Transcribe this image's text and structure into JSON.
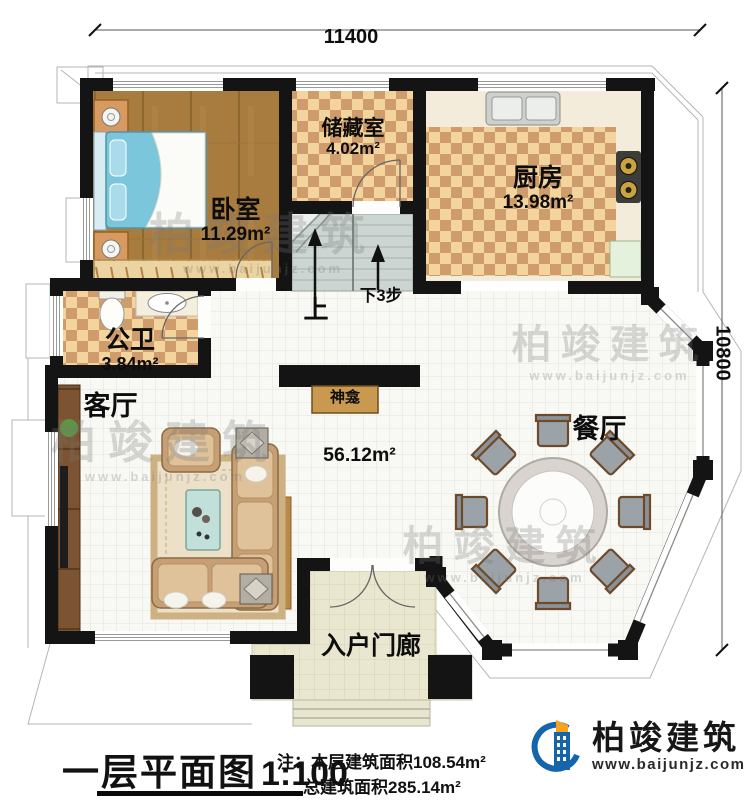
{
  "plan": {
    "dimension_top": "11400",
    "dimension_right": "10800",
    "rooms": {
      "bedroom": {
        "name": "卧室",
        "area": "11.29m²"
      },
      "storage": {
        "name": "储藏室",
        "area": "4.02m²"
      },
      "kitchen": {
        "name": "厨房",
        "area": "13.98m²"
      },
      "bathroom": {
        "name": "公卫",
        "area": "3.84m²"
      },
      "living_room": {
        "name": "客厅"
      },
      "dining_room": {
        "name": "餐厅"
      },
      "entry_porch": {
        "name": "入户门廊"
      },
      "shrine": {
        "name": "神龛"
      },
      "open_area": {
        "area": "56.12m²"
      }
    },
    "stairs": {
      "up": "上",
      "down": "下3步"
    }
  },
  "title_block": {
    "title": "一层平面图",
    "scale": "1:100",
    "note_line1": "注：本层建筑面积108.54m²",
    "note_line2": "总建筑面积285.14m²"
  },
  "brand": {
    "name": "柏竣建筑",
    "website": "www.baijunjz.com"
  },
  "watermark": {
    "name": "柏竣建筑",
    "website": "www.baijunjz.com"
  },
  "colors": {
    "wall": "#141414",
    "wood_floor": "#a87c3f",
    "checker_light": "#f2d49c",
    "checker_dark": "#cf9d6d",
    "tile": "#f8f8f4",
    "porch": "#eae7d0",
    "stair": "#ccd5d1",
    "brand_blue": "#1565ab",
    "brand_orange": "#f6a41e"
  }
}
